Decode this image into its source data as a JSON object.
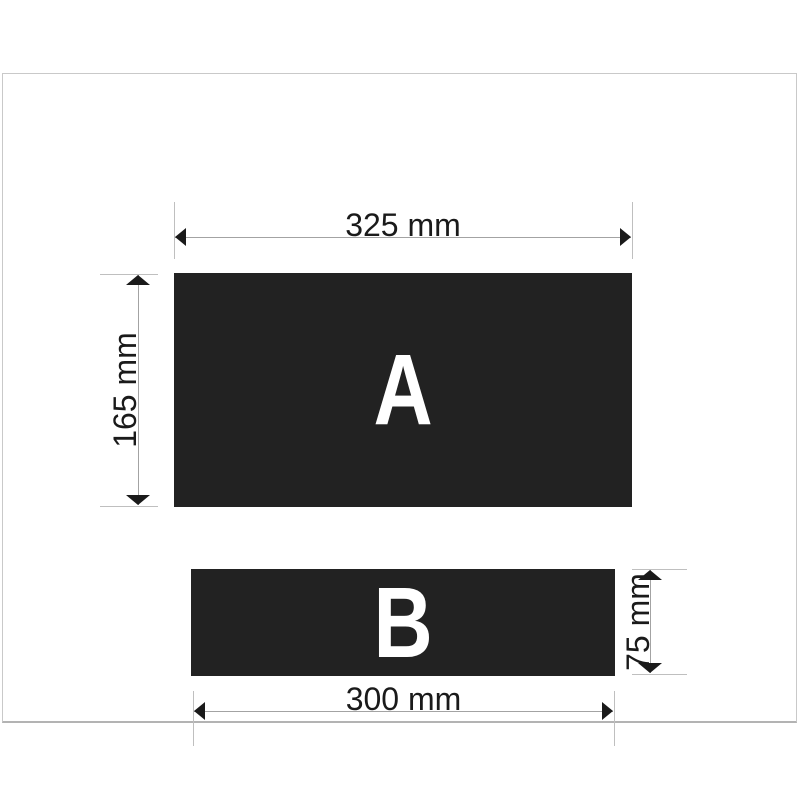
{
  "figure": {
    "panels": [
      {
        "label": "A",
        "width_label": "325 mm",
        "height_label": "165 mm"
      },
      {
        "label": "B",
        "width_label": "300 mm",
        "height_label": "75 mm"
      }
    ]
  },
  "colors": {
    "background": "#ffffff",
    "frame_border": "#c9c9c9",
    "panel_fill": "#222222",
    "panel_letter": "#ffffff",
    "dimension_line": "#a3a3a3",
    "extension_line": "#bfbfbf",
    "arrowhead": "#1a1a1a",
    "dimension_text": "#1a1a1a"
  }
}
